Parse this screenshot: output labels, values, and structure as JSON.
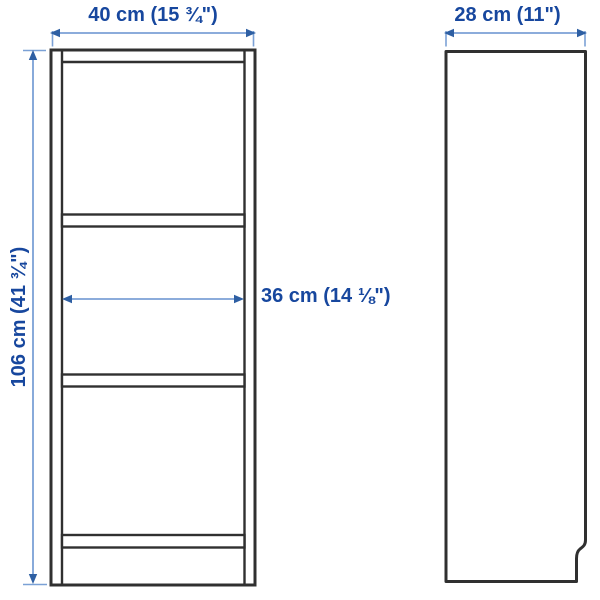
{
  "diagram": {
    "kind": "furniture-dimension-diagram",
    "views": [
      "front",
      "side"
    ],
    "colors": {
      "background": "#FFFFFF",
      "outline": "#303030",
      "dimension_line": "#7BA1D6",
      "arrowhead": "#2E5FA3",
      "label_text": "#17479E"
    },
    "front_view": {
      "width_label": "40 cm (15 ¾\")",
      "width_cm": 40,
      "width_inches": "15 ¾\"",
      "height_label": "106 cm (41 ¾\")",
      "height_cm": 106,
      "height_inches": "41 ¾\"",
      "inner_width_label": "36 cm (14 ⅛\")",
      "inner_width_cm": 36,
      "inner_width_inches": "14 ⅛\"",
      "shelf_count": 3
    },
    "side_view": {
      "depth_label": "28 cm (11\")",
      "depth_cm": 28,
      "depth_inches": "11\""
    }
  }
}
